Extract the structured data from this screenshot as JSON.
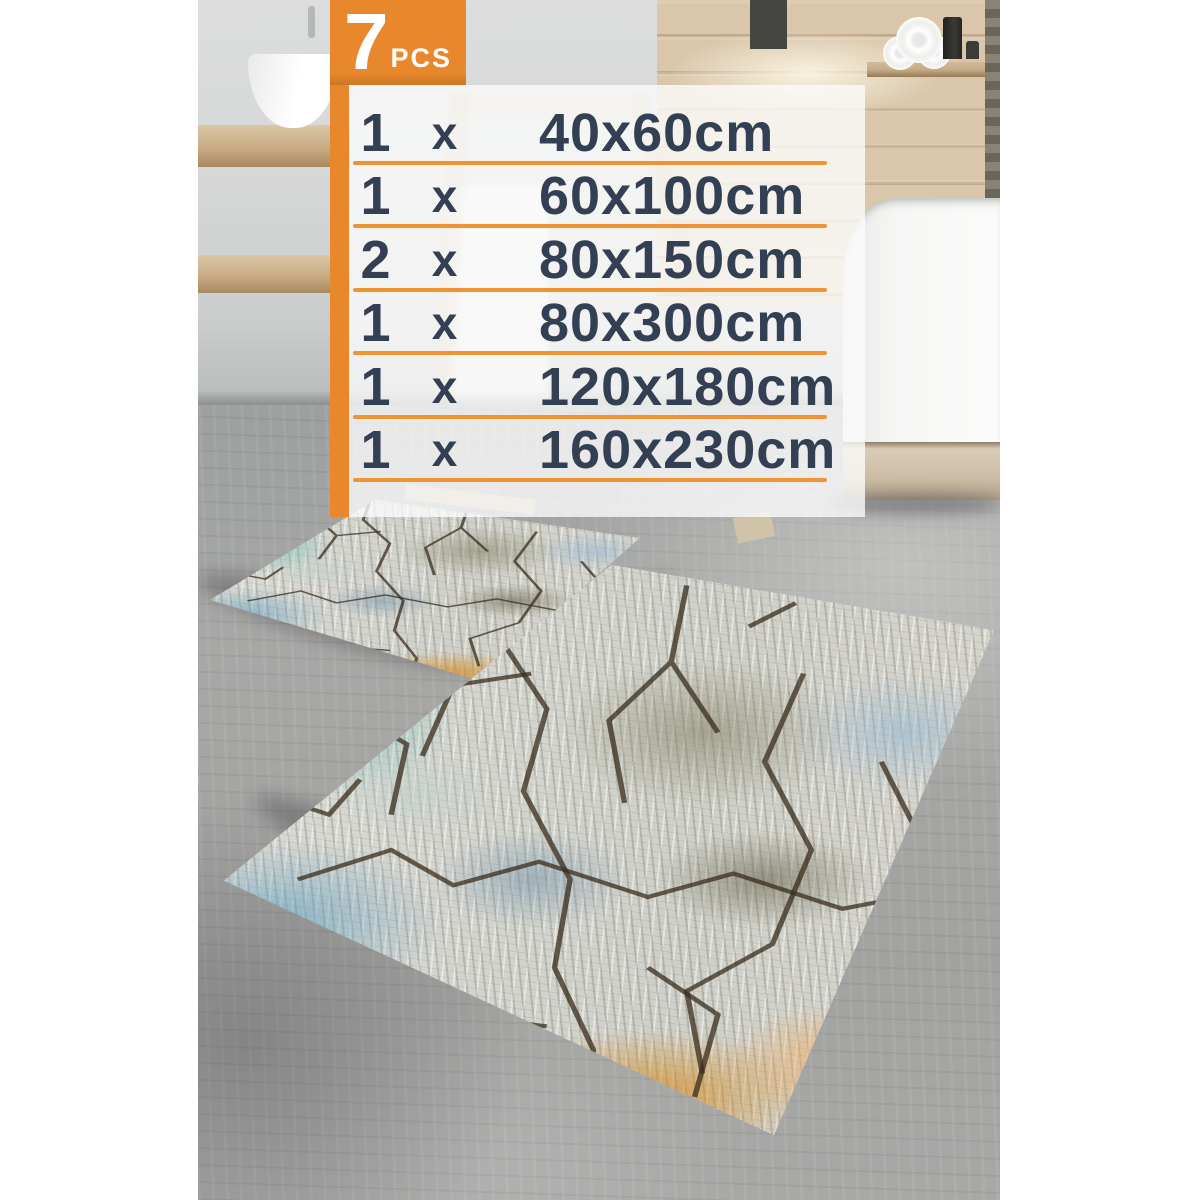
{
  "badge": {
    "count": "7",
    "unit": "PCS"
  },
  "size_list": {
    "rows": [
      {
        "qty": "1",
        "times": "x",
        "size": "40x60cm"
      },
      {
        "qty": "1",
        "times": "x",
        "size": "60x100cm"
      },
      {
        "qty": "2",
        "times": "x",
        "size": "80x150cm"
      },
      {
        "qty": "1",
        "times": "x",
        "size": "80x300cm"
      },
      {
        "qty": "1",
        "times": "x",
        "size": "120x180cm"
      },
      {
        "qty": "1",
        "times": "x",
        "size": "160x230cm"
      }
    ]
  },
  "colors": {
    "accent_orange": "#E8872B",
    "underline_orange": "#F09433",
    "text_navy": "#333F52"
  }
}
